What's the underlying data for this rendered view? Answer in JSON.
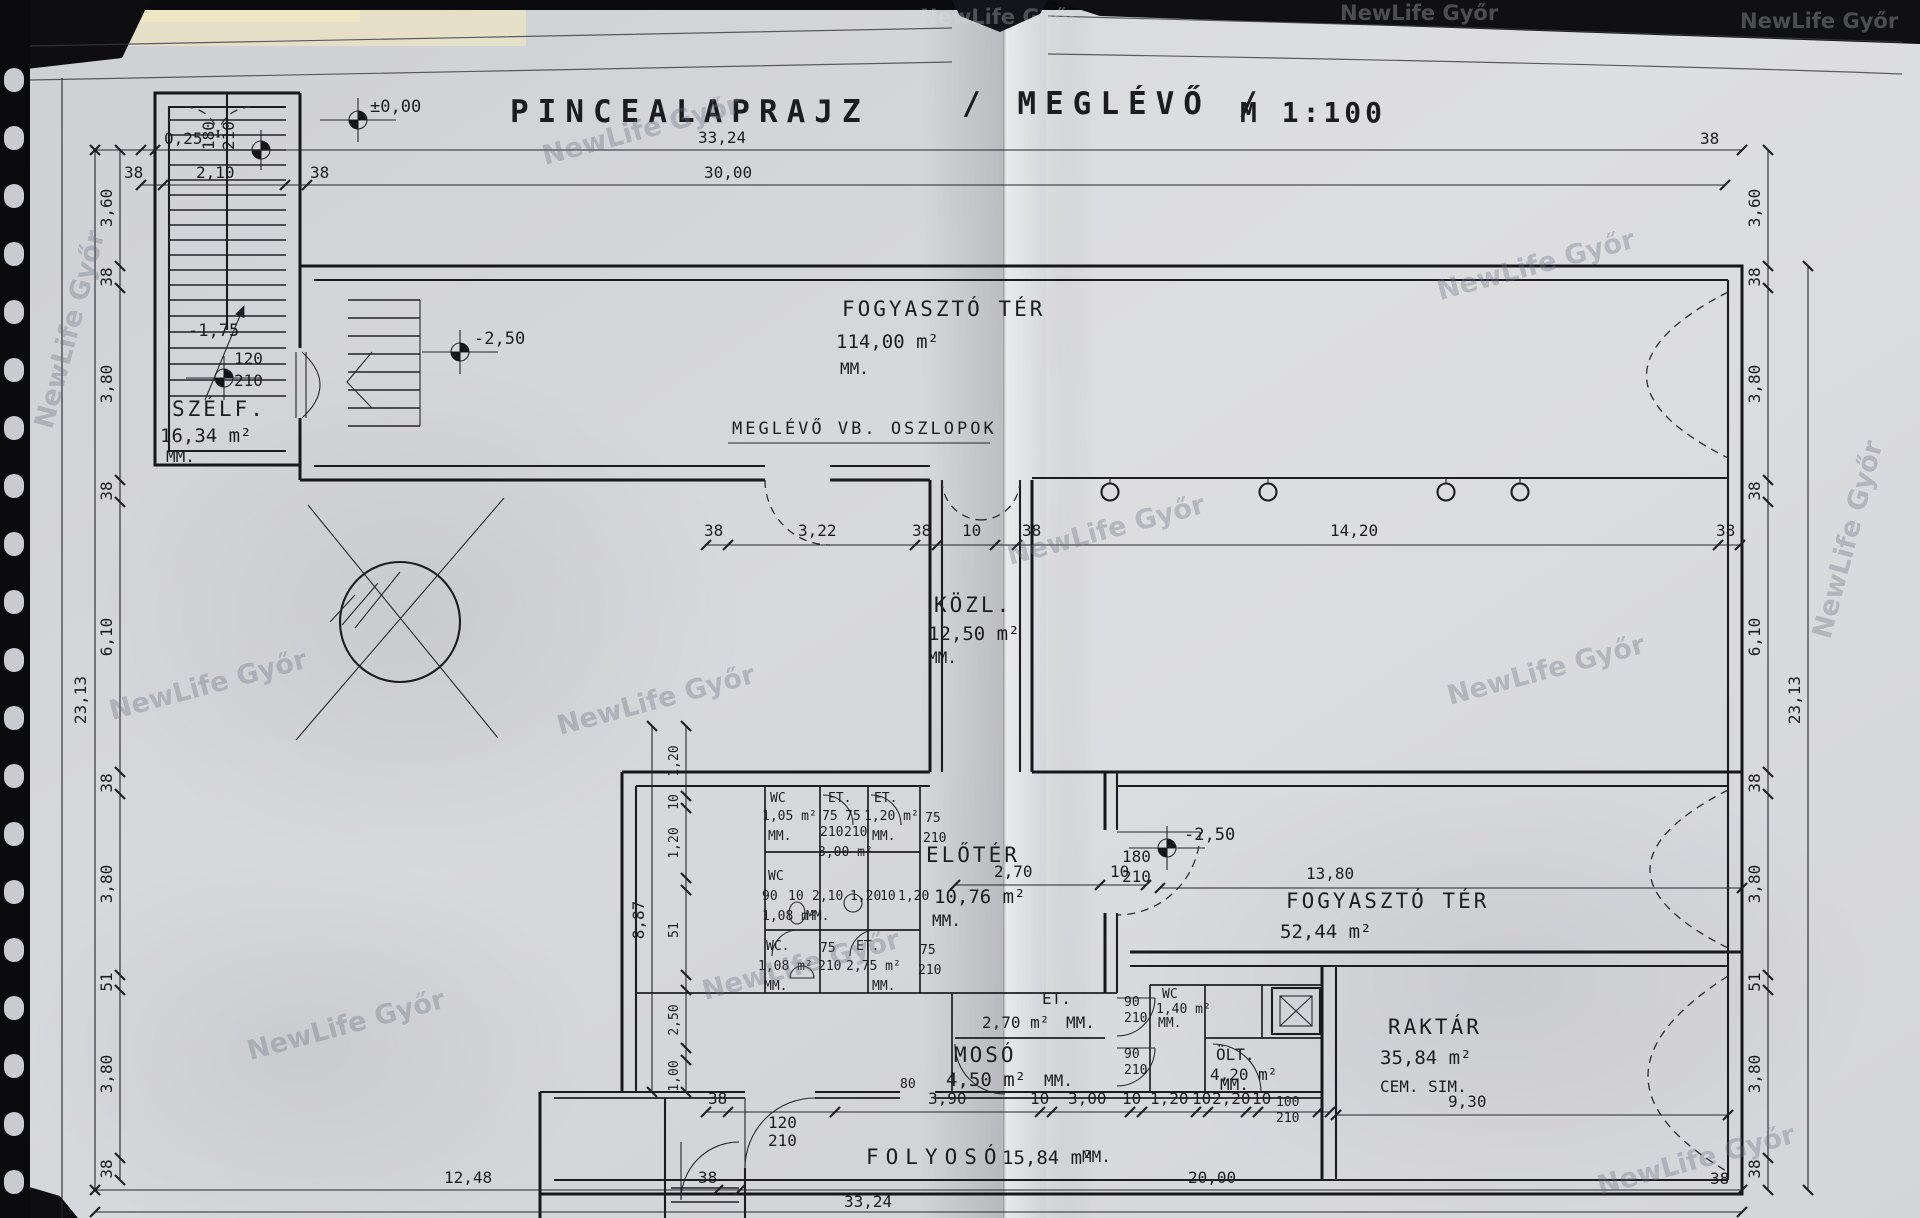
{
  "title": {
    "name": "PINCEALAPRAJZ",
    "variant": "/ MEGLÉVŐ /",
    "scale": "M 1:100"
  },
  "watermark": {
    "text": "NewLife Győr"
  },
  "annotations": {
    "columns_note": "MEGLÉVŐ  VB. OSZLOPOK"
  },
  "levels": {
    "zero": "±0,00",
    "minus175": "-1,75",
    "minus250": "-2,50"
  },
  "rooms": {
    "fogyaszto_felso": {
      "name": "FOGYASZTÓ  TÉR",
      "area": "114,00 m²",
      "note": "MM."
    },
    "szelf": {
      "name": "SZÉLF.",
      "area": "16,34 m²",
      "note": "MM."
    },
    "kozl": {
      "name": "KÖZL.",
      "area": "12,50 m²",
      "note": "MM."
    },
    "eloter": {
      "name": "ELŐTÉR",
      "area": "10,76 m²",
      "note": "MM."
    },
    "fogyaszto_also": {
      "name": "FOGYASZTÓ  TÉR",
      "area": "52,44 m²"
    },
    "raktar": {
      "name": "RAKTÁR",
      "area": "35,84 m²",
      "note": "CEM. SIM."
    },
    "moso": {
      "name": "MOSÓ",
      "area": "4,50 m²",
      "note": "MM."
    },
    "et_kozep": {
      "name": "ET.",
      "area": "2,70 m²",
      "note": "MM."
    },
    "wc_also": {
      "name": "WC",
      "area": "1,40 m²",
      "note": "MM."
    },
    "olt": {
      "name": "ÖLT.",
      "area": "4,20 m²",
      "note": "MM."
    },
    "folyoso": {
      "name": "FOLYOSÓ",
      "area": "15,84 m²",
      "note": "MM."
    },
    "wc1": {
      "name": "WC",
      "area": "1,05 m²",
      "note": "MM."
    },
    "et1": {
      "name": "ET.",
      "area": "3,00 m²"
    },
    "et2": {
      "name": "ET.",
      "area": "1,20 m²",
      "note": "MM."
    },
    "wc2": {
      "name": "WC",
      "area": "1,08 m²",
      "note": "MM."
    },
    "wc3": {
      "name": "WC.",
      "area": "1,08 m²",
      "note": "MM."
    },
    "et3": {
      "name": "ET.",
      "area": "2,75 m²",
      "note": "MM."
    }
  },
  "dims": {
    "d33_24": "33,24",
    "d30_00": "30,00",
    "d3_60": "3,60",
    "d38": "38",
    "d2_10": "2,10",
    "d0_25": "0,25",
    "d3_80": "3,80",
    "d6_10": "6,10",
    "d23_13": "23,13",
    "d1_20": "1,20",
    "d10": "10",
    "d51": "51",
    "d8_87": "8,87",
    "d2_50": "2,50",
    "d1_00": "1,00",
    "d12_48": "12,48",
    "d20_00": "20,00",
    "d3_22": "3,22",
    "d14_20": "14,20",
    "d13_80": "13,80",
    "d2_70": "2,70",
    "d9_30": "9,30",
    "d3_90": "3,90",
    "d3_00": "3,00",
    "d2_20": "2,20"
  },
  "doors": {
    "w75": "75",
    "w80": "80",
    "w90": "90",
    "w100": "100",
    "w120": "120",
    "w180": "180",
    "h210": "210"
  },
  "colors": {
    "paper": "#d6d7da",
    "ink": "#1c1c20",
    "binding": "#0b0b0d",
    "cream": "#e9e2c6"
  }
}
